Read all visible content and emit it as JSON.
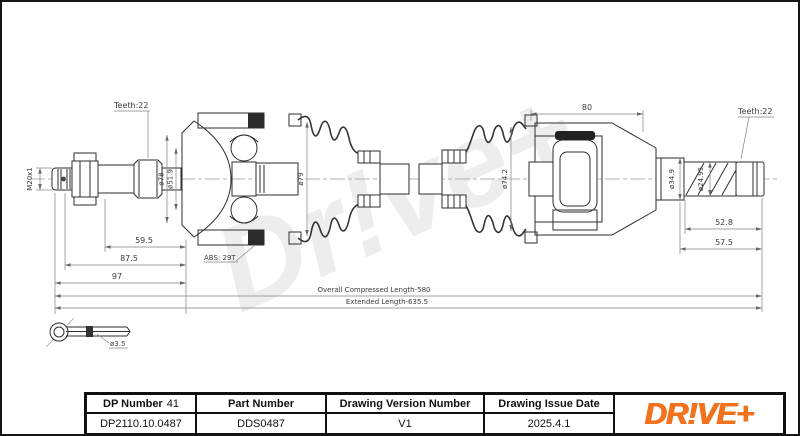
{
  "page": {
    "background": "#ffffff",
    "frame_color": "#151515"
  },
  "drawing": {
    "watermark": "Dr!ve+",
    "labels": {
      "teeth_left": "Teeth:22",
      "thread": "M20x1",
      "dia_bell_outer": "ø78",
      "dia_bell_inner": "ø51.9",
      "abs_ring": "ABS: 29T",
      "dia_boot_left": "ø79",
      "dim_59_5": "59.5",
      "dim_87_5": "87.5",
      "dim_97": "97",
      "dia_boot_right": "ø74.2",
      "dim_housing": "80",
      "dia_shaft_right": "ø34.9",
      "dia_spline_right": "ø24.95",
      "teeth_right": "Teeth:22",
      "dim_52_8": "52.8",
      "dim_57_5": "57.5",
      "overall_compressed": "Overall Compressed Length-580",
      "extended": "Extended Length-635.5",
      "pin_dia": "ø3.5"
    }
  },
  "title_block": {
    "columns": [
      {
        "label": "DP Number",
        "label_suffix": "41",
        "value": "DP2110.10.0487"
      },
      {
        "label": "Part Number",
        "value": "DDS0487"
      },
      {
        "label": "Drawing Version Number",
        "value": "V1"
      },
      {
        "label": "Drawing Issue Date",
        "value": "2025.4.1"
      }
    ],
    "logo": "DR!VE+",
    "logo_color": "#F2731D"
  }
}
